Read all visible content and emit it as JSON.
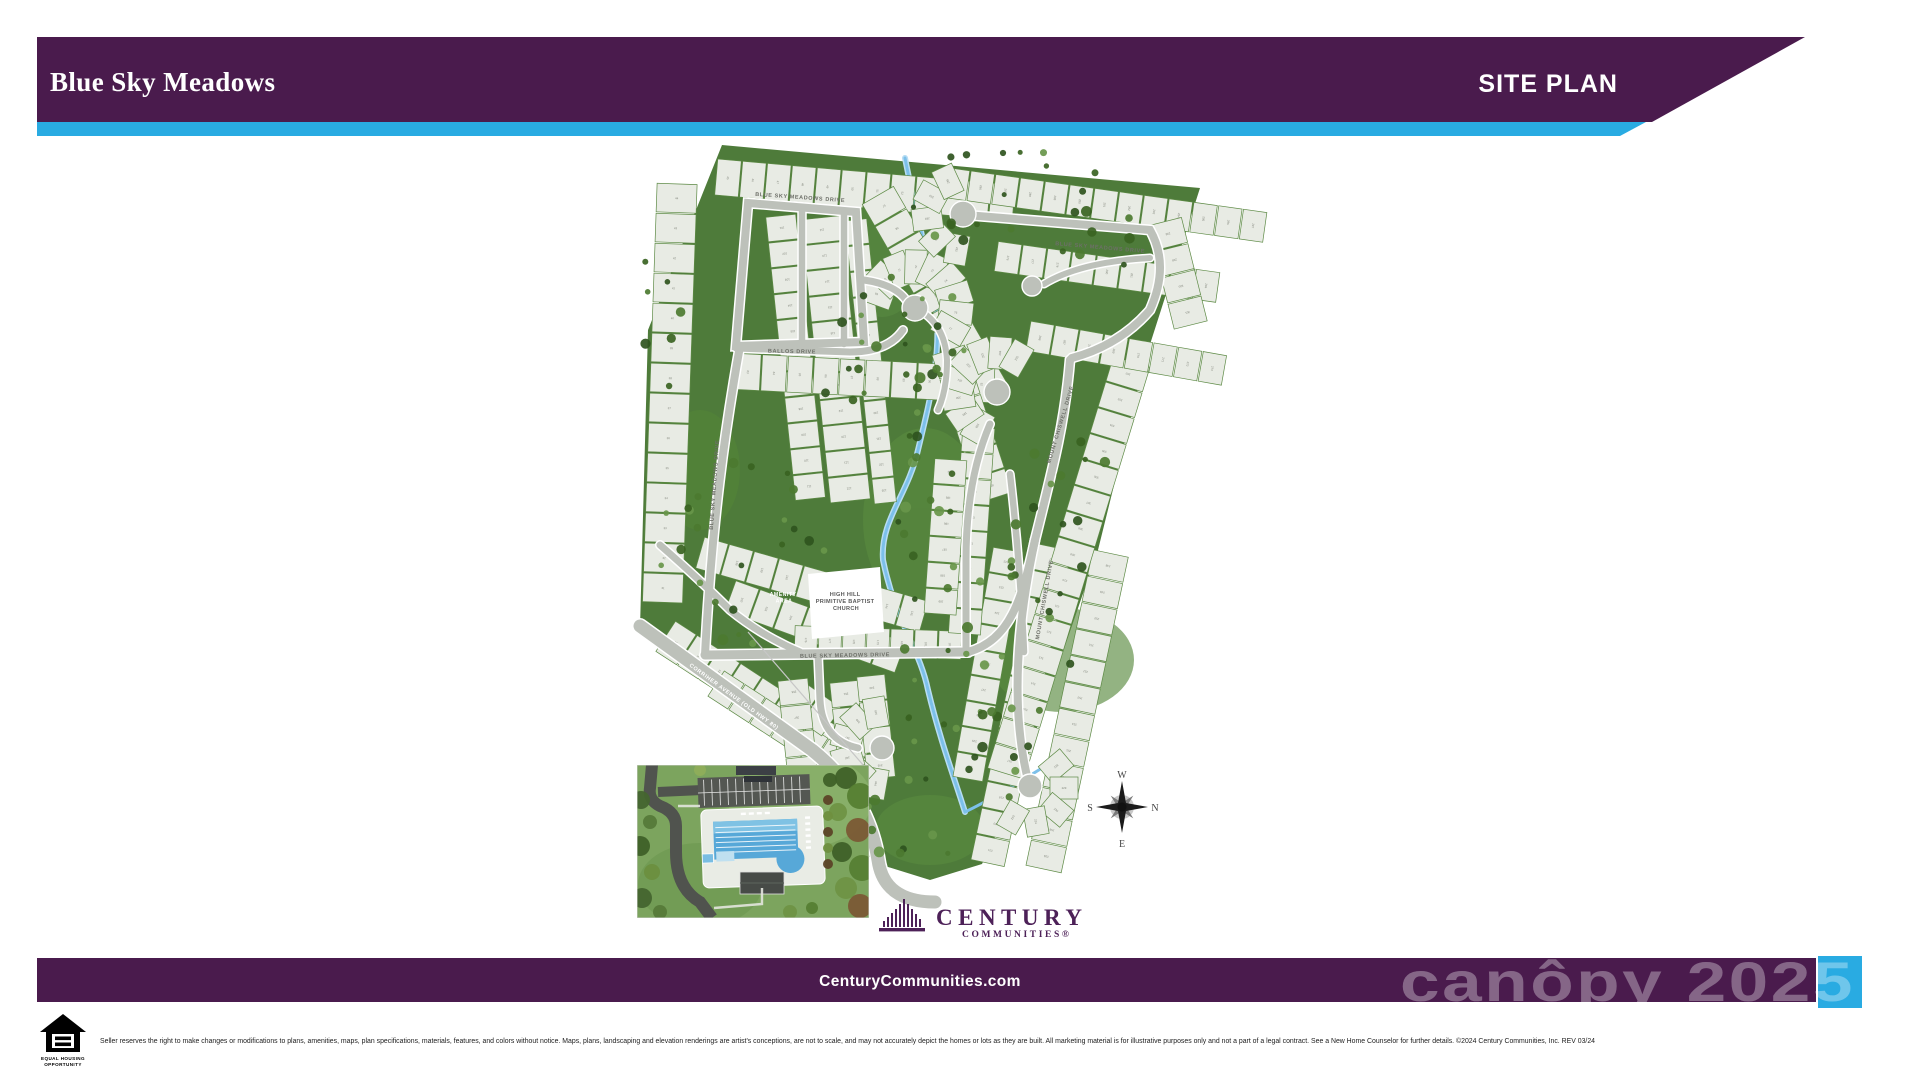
{
  "colors": {
    "banner_purple": "#4A1B4D",
    "accent_cyan": "#29ABE2",
    "map_green": "#4E7B3A",
    "road_gray": "#BDC1BA",
    "lot_fill": "#E8EBE4",
    "creek_blue": "#7CC0EA",
    "logo_purple": "#4D2158",
    "watermark": "rgba(255,255,255,0.33)"
  },
  "header": {
    "title": "Blue Sky Meadows",
    "page_label": "SITE PLAN"
  },
  "map": {
    "streets": {
      "blue_sky_meadows_drive": "BLUE SKY MEADOWS DRIVE",
      "ballos_drive": "BALLOS DRIVE",
      "corriher_avenue": "CORRIHER AVENUE (OLD HWY 80)",
      "chiswell_drive": "MOUNT CHISWELL DRIVE"
    },
    "places": {
      "amenity_line1": "AMENITY",
      "amenity_line2": "AREA",
      "church_line1": "HIGH HILL",
      "church_line2": "PRIMITIVE BAPTIST",
      "church_line3": "CHURCH"
    },
    "compass": {
      "top": "W",
      "right": "N",
      "left": "S",
      "bottom": "E"
    }
  },
  "brand": {
    "name": "CENTURY",
    "subtitle": "COMMUNITIES®"
  },
  "footer": {
    "website": "CenturyCommunities.com",
    "watermark": "canôpy 2025",
    "eho_line1": "EQUAL HOUSING",
    "eho_line2": "OPPORTUNITY",
    "disclaimer": "Seller reserves the right to make changes or modifications to plans, amenities, maps, plan specifications, materials, features, and colors without notice. Maps, plans, landscaping and elevation renderings are artist's conceptions, are not to scale, and may not accurately depict the homes or lots as they are built. All marketing material is for illustrative purposes only and not a part of a legal contract. See a New Home Counselor for further details. ©2024 Century Communities, Inc. REV 03/24"
  }
}
